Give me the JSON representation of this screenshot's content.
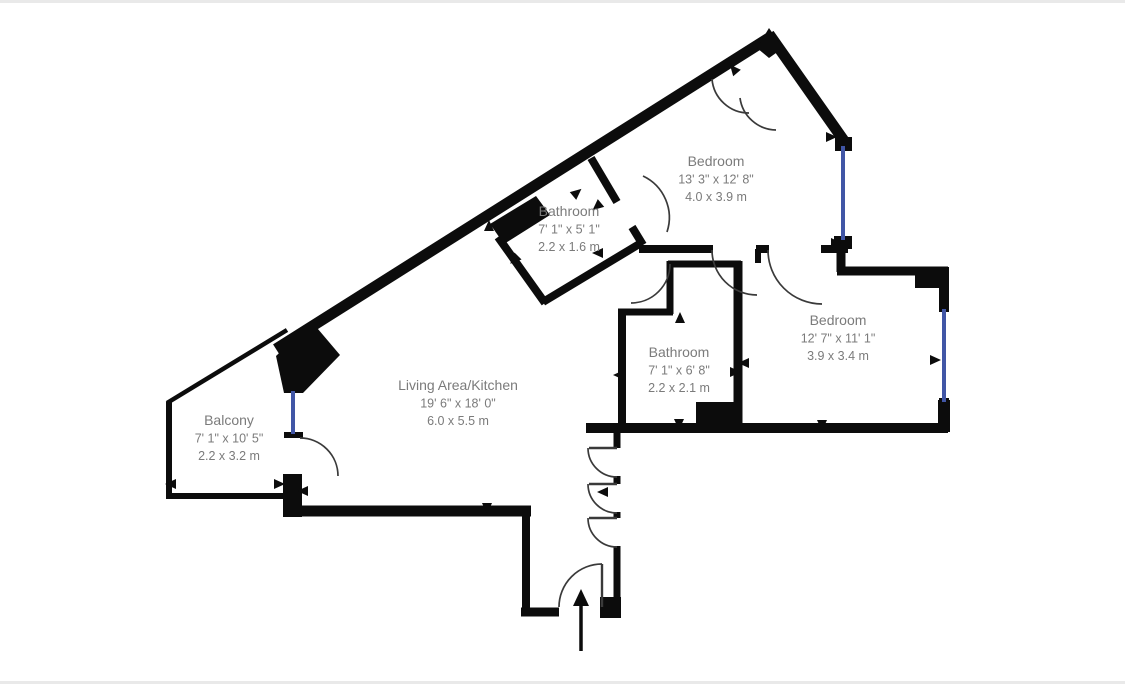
{
  "title": "Apartment floor plan",
  "colors": {
    "wall": "#0c0c0c",
    "window": "#4156a6",
    "arc": "#3a3a3a",
    "text": "#7b7b7b",
    "background": "#ffffff",
    "edge_strip": "#e9e9e9"
  },
  "rooms": [
    {
      "name": "Bedroom",
      "imperial": "13' 3\" x 12' 8\"",
      "metric": "4.0 x 3.9 m",
      "x": 716,
      "y": 166
    },
    {
      "name": "Bathroom",
      "imperial": "7' 1\" x 5' 1\"",
      "metric": "2.2 x 1.6 m",
      "x": 569,
      "y": 216
    },
    {
      "name": "Bedroom",
      "imperial": "12' 7\" x 11' 1\"",
      "metric": "3.9 x 3.4 m",
      "x": 838,
      "y": 325
    },
    {
      "name": "Bathroom",
      "imperial": "7' 1\" x 6' 8\"",
      "metric": "2.2 x 2.1 m",
      "x": 679,
      "y": 357
    },
    {
      "name": "Living Area/Kitchen",
      "imperial": "19' 6\" x 18' 0\"",
      "metric": "6.0 x 5.5 m",
      "x": 458,
      "y": 390
    },
    {
      "name": "Balcony",
      "imperial": "7' 1\" x 10' 5\"",
      "metric": "2.2 x 3.2 m",
      "x": 229,
      "y": 425
    }
  ],
  "geometry": {
    "canvas": {
      "width": 1125,
      "height": 684
    },
    "walls": [
      [
        276,
        349,
        772,
        36,
        11
      ],
      [
        769,
        34,
        847,
        145,
        11
      ],
      [
        841,
        247,
        841,
        272,
        9
      ],
      [
        837,
        271,
        948,
        271,
        9
      ],
      [
        944,
        268,
        944,
        312,
        10
      ],
      [
        944,
        398,
        944,
        430,
        10
      ],
      [
        586,
        428,
        948,
        428,
        10
      ],
      [
        639,
        249,
        713,
        249,
        8
      ],
      [
        756,
        249,
        769,
        249,
        8
      ],
      [
        821,
        249,
        848,
        249,
        8
      ],
      [
        758,
        249,
        758,
        263,
        6
      ],
      [
        622,
        310,
        622,
        430,
        8
      ],
      [
        618,
        312,
        673,
        312,
        7
      ],
      [
        670,
        261,
        670,
        314,
        7
      ],
      [
        668,
        264,
        741,
        264,
        7
      ],
      [
        738,
        261,
        738,
        430,
        9
      ],
      [
        617,
        428,
        617,
        448,
        7
      ],
      [
        617,
        476,
        617,
        484,
        7
      ],
      [
        617,
        512,
        617,
        518,
        7
      ],
      [
        617,
        546,
        617,
        601,
        7
      ],
      [
        521,
        612,
        559,
        612,
        9
      ],
      [
        526,
        506,
        526,
        616,
        8
      ],
      [
        284,
        511,
        531,
        511,
        11
      ],
      [
        169,
        402,
        169,
        499,
        6
      ],
      [
        166,
        496,
        289,
        496,
        6
      ],
      [
        167,
        403,
        287,
        330,
        4.5
      ],
      [
        591,
        158,
        617,
        202,
        8
      ],
      [
        632,
        227,
        643,
        245,
        8
      ],
      [
        641,
        243,
        543,
        302,
        8
      ],
      [
        545,
        303,
        498,
        237,
        8
      ]
    ],
    "wall_rects": [
      [
        835,
        137,
        17,
        14
      ],
      [
        834,
        236,
        18,
        13
      ],
      [
        915,
        267,
        34,
        21
      ],
      [
        938,
        400,
        12,
        32
      ],
      [
        696,
        402,
        46,
        26
      ],
      [
        600,
        597,
        21,
        21
      ],
      [
        284,
        432,
        19,
        6
      ],
      [
        283,
        474,
        19,
        43
      ]
    ],
    "wall_polygons": [
      "757,48 769,28 783,48 769,58",
      "276,356 312,322 340,355 303,393 284,393",
      "490,224 536,196 550,215 504,244"
    ],
    "windows": [
      [
        843,
        146,
        843,
        240
      ],
      [
        944,
        309,
        944,
        402
      ],
      [
        293,
        391,
        293,
        434
      ]
    ],
    "door_arcs": [
      "M 712 250 A 45 45 0 0 0 757 295",
      "M 768 250 A 54 54 0 0 0 822 304",
      "M 670 264 A 39 39 0 0 1 631 303",
      "M 643 176 A 46 46 0 0 1 667 232",
      "M 712 79 A 37 37 0 0 0 749 113",
      "M 740 98 A 37 37 0 0 0 776 130",
      "M 300 438 A 38 38 0 0 1 338 476",
      "M 588 448 A 29 29 0 0 0 617 477",
      "M 588 484 A 29 29 0 0 0 617 513",
      "M 588 518 A 29 29 0 0 0 617 547",
      "M 602 564 A 43 43 0 0 0 559 607"
    ],
    "door_leaves": [
      [
        617,
        448,
        589,
        448
      ],
      [
        617,
        484,
        589,
        484
      ],
      [
        617,
        518,
        589,
        518
      ],
      [
        602,
        607,
        602,
        564
      ]
    ],
    "threshold_arrows": [
      [
        573,
        196,
        -40
      ],
      [
        601,
        203,
        140
      ],
      [
        489,
        231,
        -90
      ],
      [
        518,
        256,
        135
      ],
      [
        603,
        253,
        180
      ],
      [
        680,
        323,
        -90
      ],
      [
        730,
        372,
        0
      ],
      [
        749,
        363,
        180
      ],
      [
        624,
        375,
        180
      ],
      [
        679,
        419,
        90
      ],
      [
        822,
        420,
        90
      ],
      [
        930,
        360,
        0
      ],
      [
        826,
        137,
        0
      ],
      [
        831,
        243,
        0
      ],
      [
        176,
        484,
        180
      ],
      [
        274,
        484,
        0
      ],
      [
        308,
        491,
        180
      ],
      [
        487,
        503,
        90
      ],
      [
        608,
        492,
        180
      ],
      [
        737,
        73,
        -130
      ]
    ],
    "entrance_arrow": {
      "line": [
        581,
        651,
        581,
        604
      ],
      "head": "581,589 573,606 589,606"
    }
  },
  "label_style": {
    "name_size": 14,
    "dim_size": 12.5,
    "line_gap": 17.5
  }
}
